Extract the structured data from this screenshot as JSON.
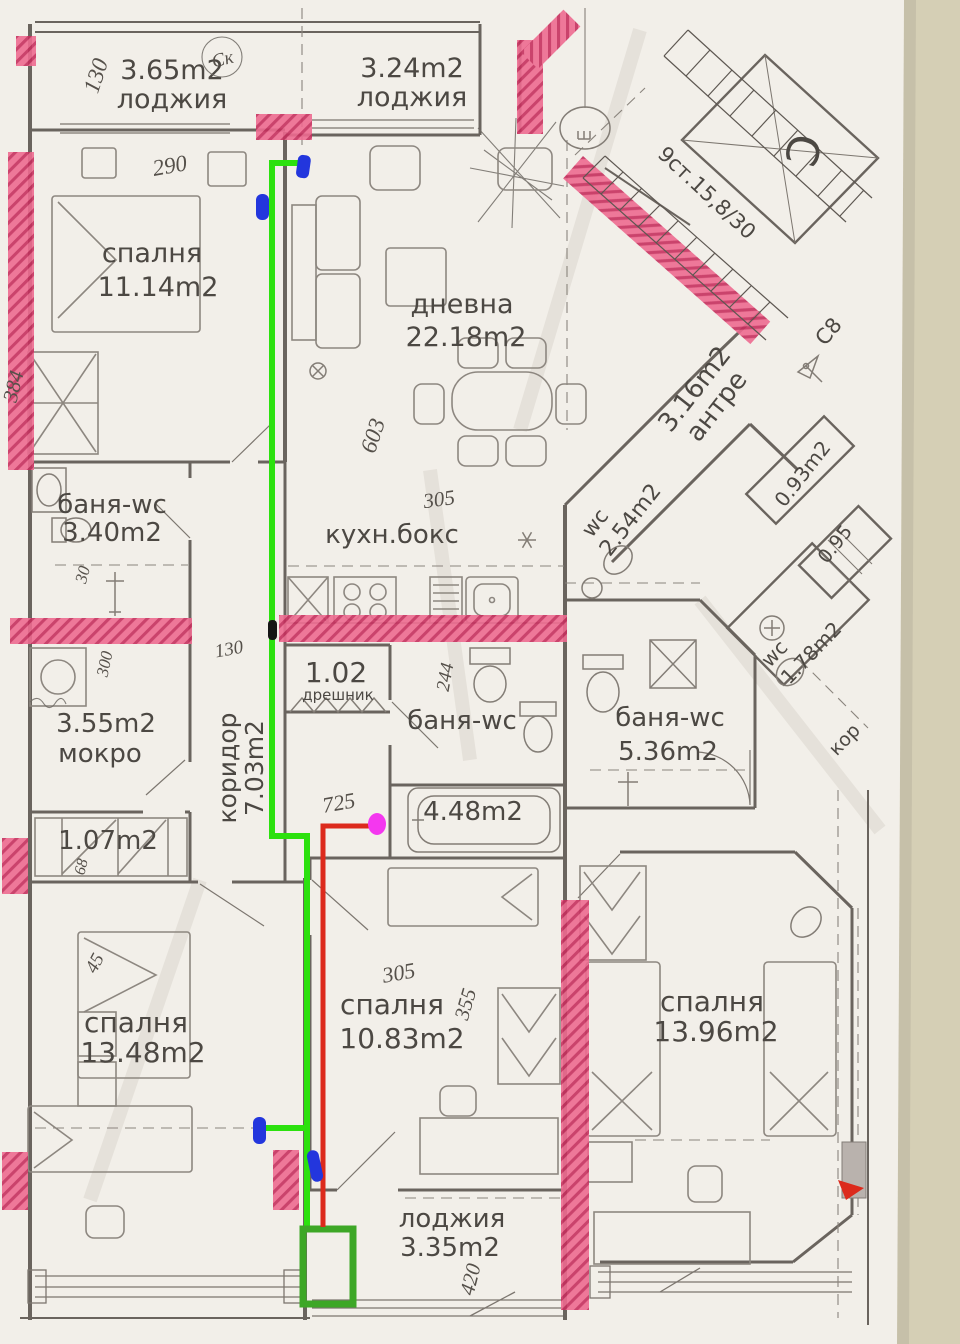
{
  "colors": {
    "paper": "#f2efe9",
    "table": "#d5cfb5",
    "paper_shadow": "#c6c0a9",
    "highlight_pink": "#ee6a90",
    "highlight_pink_dark": "#c62f5e",
    "green_line": "#2ce10e",
    "green_box": "#3da726",
    "red_line": "#dc2a1c",
    "blue_mark": "#2336dd",
    "magenta_mark": "#f437ef",
    "black_mark": "#151515",
    "gray_block": "#b9b2ad"
  },
  "rooms": {
    "loggia_left": {
      "area": "3.65m2",
      "name": "лоджия"
    },
    "loggia_top": {
      "area": "3.24m2",
      "name": "лоджия"
    },
    "bedroom_11": {
      "name": "спалня",
      "area": "11.14m2"
    },
    "living": {
      "name": "дневна",
      "area": "22.18m2"
    },
    "antre": {
      "area": "3.16m2",
      "name": "антре"
    },
    "bath_340": {
      "name": "баня-wc",
      "area": "3.40m2"
    },
    "kitchen": {
      "name": "кухн.бокс"
    },
    "wc_254": {
      "name": "wc",
      "area": "2.54m2"
    },
    "closet_093": {
      "area": "0.93m2"
    },
    "closet_095": {
      "area": "0.95"
    },
    "wc_178": {
      "name": "wc",
      "area": "1.78m2"
    },
    "dreshnik": {
      "area": "1.02",
      "name": "дрешник"
    },
    "bath_mid": {
      "name": "баня-wc"
    },
    "bath_536": {
      "name": "баня-wc",
      "area": "5.36m2"
    },
    "mokro": {
      "area": "3.55m2",
      "name": "мокро"
    },
    "corridor": {
      "name": "коридор",
      "area": "7.03m2"
    },
    "bath_448": {
      "area": "4.48m2"
    },
    "closet_107": {
      "area": "1.07m2"
    },
    "bedroom_1348": {
      "name": "спалня",
      "area": "13.48m2"
    },
    "bedroom_1083": {
      "name": "спалня",
      "area": "10.83m2"
    },
    "bedroom_1396": {
      "name": "спалня",
      "area": "13.96m2"
    },
    "loggia_bottom": {
      "name": "лоджия",
      "area": "3.35m2"
    },
    "corridor_right": {
      "name": "кор"
    }
  },
  "stairs": {
    "label": "9ст.15,8/30"
  },
  "marks": {
    "circled_sk": "Ск",
    "section_c8": "С8",
    "big_c": "C",
    "shaft": "№"
  },
  "handwritten": {
    "h130_top": "130",
    "h290": "290",
    "h384": "384",
    "h603": "603",
    "h305_kitchen": "305",
    "h244": "244",
    "h130_mid": "130",
    "h30": "30",
    "h300": "300",
    "h725": "725",
    "h45": "45",
    "h68": "68",
    "h305_bed": "305",
    "h355": "355",
    "h420": "420"
  }
}
